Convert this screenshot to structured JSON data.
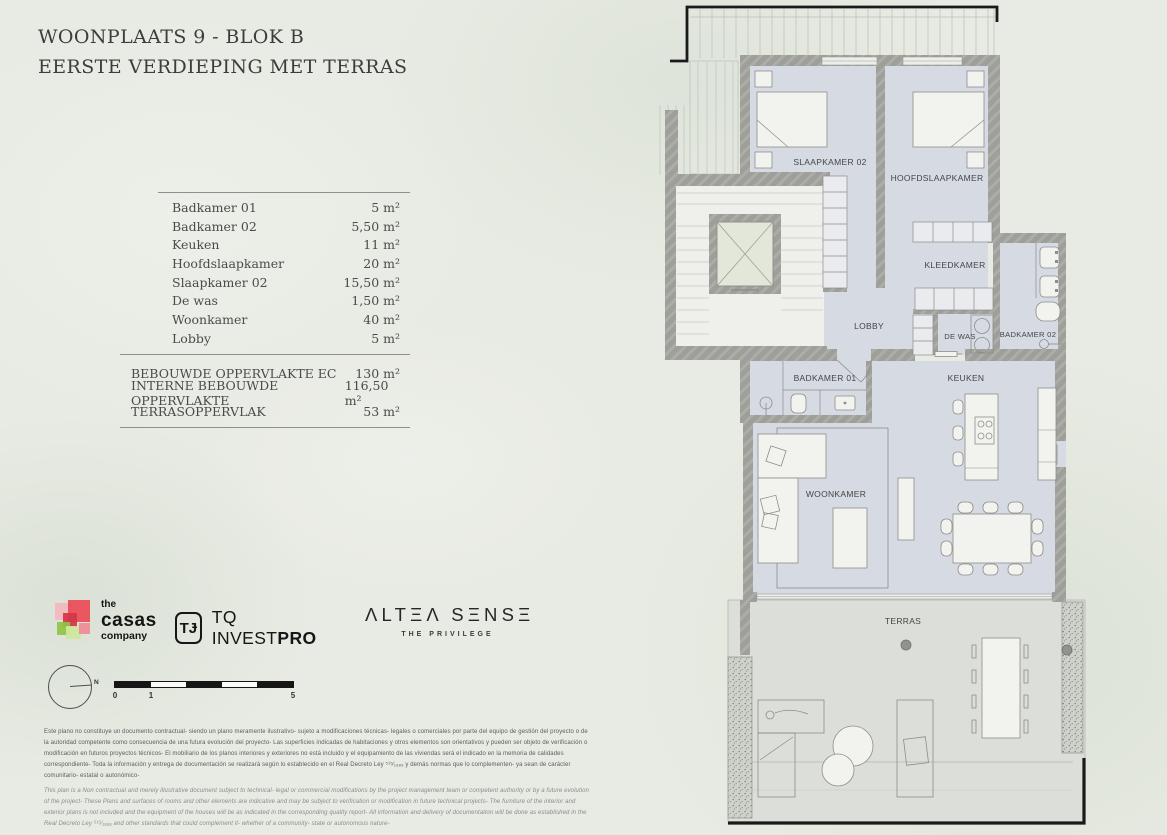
{
  "title": {
    "line1": "WOONPLAATS 9 - BLOK B",
    "line2": "EERSTE VERDIEPING MET TERRAS"
  },
  "area_table": {
    "rows": [
      {
        "label": "Badkamer 01",
        "value": "5 m²"
      },
      {
        "label": "Badkamer 02",
        "value": "5,50 m²"
      },
      {
        "label": "Keuken",
        "value": "11 m²"
      },
      {
        "label": "Hoofdslaapkamer",
        "value": "20 m²"
      },
      {
        "label": "Slaapkamer 02",
        "value": "15,50 m²"
      },
      {
        "label": "De was",
        "value": "1,50 m²"
      },
      {
        "label": "Woonkamer",
        "value": "40 m²"
      },
      {
        "label": "Lobby",
        "value": "5 m²"
      }
    ],
    "summary": [
      {
        "label": "BEBOUWDE OPPERVLAKTE EC",
        "value": "130 m²"
      },
      {
        "label": "INTERNE BEBOUWDE OPPERVLAKTE",
        "value": "116,50 m²"
      },
      {
        "label": "TERRASOPPERVLAK",
        "value": "53 m²"
      }
    ]
  },
  "logos": {
    "casas": {
      "line1": "the",
      "line2": "casas",
      "line3": "company",
      "colors": [
        "#f2b7bd",
        "#ea4b57",
        "#d23648",
        "#8ec445",
        "#cfe79c",
        "#f08a96"
      ]
    },
    "tq": {
      "monogram": "TɈ",
      "name_regular": "TQ INVEST",
      "name_bold": "PRO"
    },
    "altea": {
      "name": "ΛLTΞΛ SΞNSΞ",
      "subtitle": "THE PRIVILEGE"
    }
  },
  "compass": {
    "north_label": "N"
  },
  "scalebar": {
    "labels": [
      "0",
      "1",
      "5"
    ]
  },
  "disclaimer": {
    "es": "Este plano no constituye un documento contractual- siendo un plano meramente ilustrativo- sujeto a modificaciones técnicas- legales o comerciales por parte del equipo de gestión del proyecto o de la autoridad competente como consecuencia de una futura evolución del proyecto- Las superficies indicadas de habitaciones y otros elementos son orientativos y pueden ser objeto de verificación o modificación en futuros proyectos técnicos- El mobiliario de los planos interiores y exteriores no está incluido y el equipamiento de las viviendas será el indicado en la memoria de calidades correspondiente- Toda la información y entrega de documentación se realizará según lo establecido en el Real Decreto Ley ⁵¹⁵⁄₁₉₈₉ y demás normas que lo complementen- ya sean de carácter comunitario- estatal o autonómico-",
    "en": "This plan is a Non contractual and merely illustrative document subject to technical- legal or commercial modifications by the project management team or competent authority or by a future evolution of the project- These Plans and surfaces of rooms and other elements are indicative and may be subject to verification or modification in future technical projects- The furniture of the interior and exterior plans is not included and the equipment of the houses will be as indicated in the corresponding quality report- All information and delivery of documentation will be done as established in the Real Decreto Ley ⁵¹⁵⁄₁₉₈₉ and other standards that could complement it- whether of a community- state or autonomous nature-"
  },
  "plan": {
    "rooms": [
      {
        "id": "slaapkamer-02",
        "label": "SLAAPKAMER 02"
      },
      {
        "id": "hoofdslaapkamer",
        "label": "HOOFDSLAAPKAMER"
      },
      {
        "id": "kleedkamer",
        "label": "KLEEDKAMER"
      },
      {
        "id": "lobby",
        "label": "LOBBY"
      },
      {
        "id": "de-was",
        "label": "DE WAS"
      },
      {
        "id": "badkamer-02",
        "label": "BADKAMER 02"
      },
      {
        "id": "badkamer-01",
        "label": "BADKAMER 01"
      },
      {
        "id": "keuken",
        "label": "KEUKEN"
      },
      {
        "id": "woonkamer",
        "label": "WOONKAMER"
      },
      {
        "id": "terras",
        "label": "TERRAS"
      }
    ]
  },
  "colors": {
    "floor": "#d6dae3",
    "wall": "#9e9e9a",
    "common_floor": "#efefeb",
    "terrace": "#dcdfd9",
    "elevator": "#e3e7da",
    "frame_line": "#1a1a1a"
  }
}
